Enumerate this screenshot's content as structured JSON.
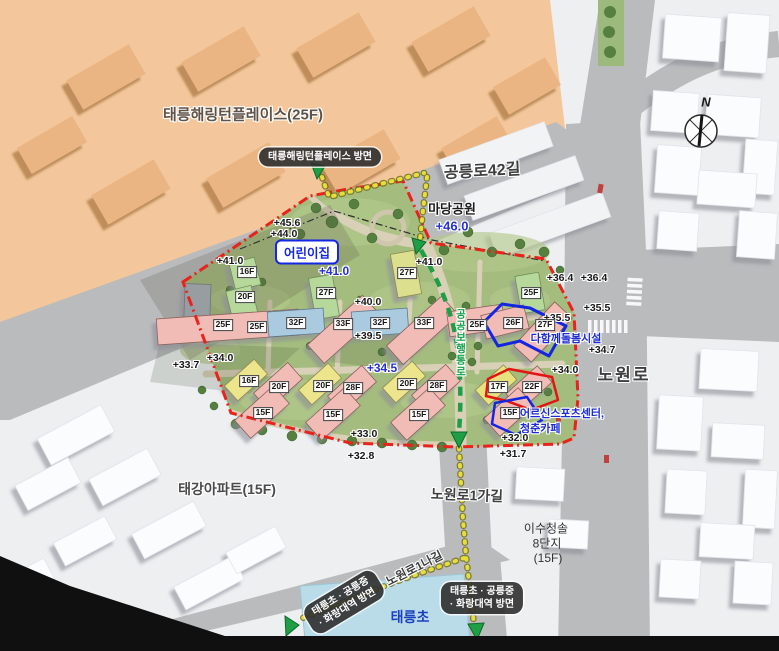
{
  "compass": {
    "north": "N"
  },
  "labels": {
    "harrington": "태릉해링턴플레이스(25F)",
    "taegang": "태강아파트(15F)",
    "isu1": "이수청솔",
    "isu2": "8단지",
    "isu3": "(15F)",
    "taereung_elem": "태릉초"
  },
  "roads": {
    "gongneungro42gil": "공릉로42길",
    "nowonro": "노원로",
    "nowonro1gagil": "노원로1가길",
    "nowonro1nagil": "노원로1나길"
  },
  "badges": {
    "harrington_direction": "태릉해링턴플레이스 방면",
    "south_line1": "태릉초 · 공릉중",
    "south_line2": "· 화랑대역 방면"
  },
  "facilities": {
    "madang_park": "마당공원",
    "madang_park_elev": "+46.0",
    "daycare": "어린이집",
    "care_center": "다함께돌봄시설",
    "senior1": "어르신스포츠센터,",
    "senior2": "청춘카페",
    "pedestrian_path": "공공보행통로"
  },
  "elevations": [
    {
      "v": "+45.6"
    },
    {
      "v": "+44.0"
    },
    {
      "v": "+41.0"
    },
    {
      "v": "+41.0"
    },
    {
      "v": "+40.0"
    },
    {
      "v": "+39.5"
    },
    {
      "v": "+33.7"
    },
    {
      "v": "+34.0"
    },
    {
      "v": "+33.0"
    },
    {
      "v": "+32.8"
    },
    {
      "v": "+36.4"
    },
    {
      "v": "+36.4"
    },
    {
      "v": "+35.5"
    },
    {
      "v": "+35.5"
    },
    {
      "v": "+34.7"
    },
    {
      "v": "+34.0"
    },
    {
      "v": "+32.0"
    },
    {
      "v": "+31.7"
    },
    {
      "v": "+41.0"
    },
    {
      "v": "+34.5"
    }
  ],
  "buildings": [
    {
      "f": "16F"
    },
    {
      "f": "20F"
    },
    {
      "f": "25F"
    },
    {
      "f": "25F"
    },
    {
      "f": "27F"
    },
    {
      "f": "32F"
    },
    {
      "f": "33F"
    },
    {
      "f": "27F"
    },
    {
      "f": "32F"
    },
    {
      "f": "33F"
    },
    {
      "f": "25F"
    },
    {
      "f": "25F"
    },
    {
      "f": "26F"
    },
    {
      "f": "27F"
    },
    {
      "f": "16F"
    },
    {
      "f": "20F"
    },
    {
      "f": "15F"
    },
    {
      "f": "20F"
    },
    {
      "f": "28F"
    },
    {
      "f": "15F"
    },
    {
      "f": "20F"
    },
    {
      "f": "28F"
    },
    {
      "f": "15F"
    },
    {
      "f": "17F"
    },
    {
      "f": "22F"
    },
    {
      "f": "15F"
    }
  ],
  "colors": {
    "boundary_red": "#e8231c",
    "route_green": "#1f9e45",
    "route_yellow": "#e8dd3a",
    "elevation_blue": "#2331d6",
    "facility_blue": "#1c2bd6",
    "building_pink": "#f1bcb5",
    "building_blue": "#a9cadf",
    "building_green": "#b6d89b",
    "building_yellow": "#ece58c",
    "district_orange": "#f3c79b"
  }
}
